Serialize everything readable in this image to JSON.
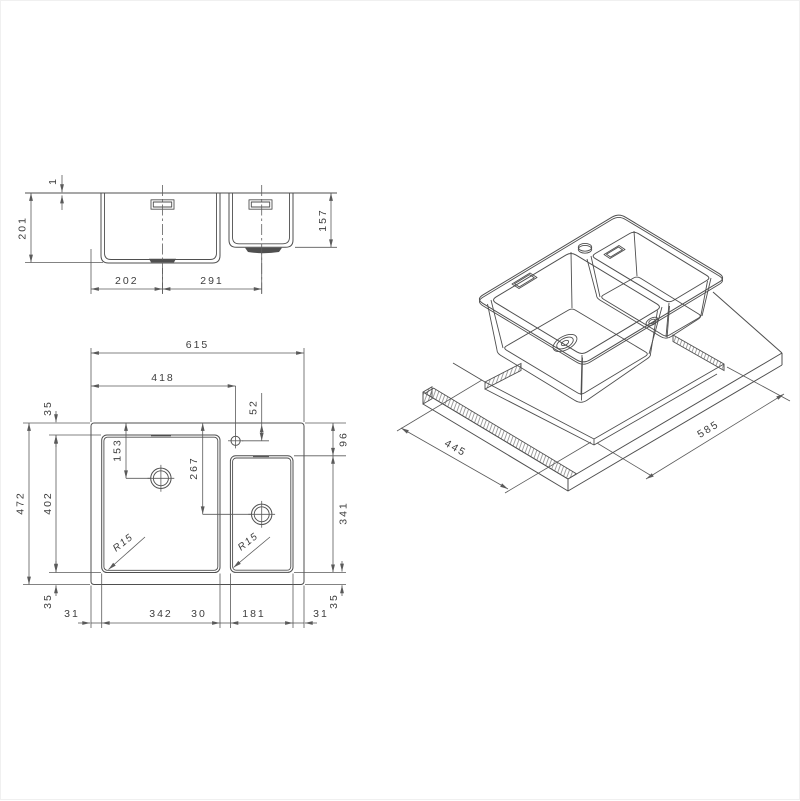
{
  "drawing": {
    "front_view": {
      "rim_thickness": "1",
      "bowl1_depth": "201",
      "bowl2_depth": "157",
      "bowl1_center_offset": "202",
      "bowl_center_distance": "291"
    },
    "plan_view": {
      "overall_width": "615",
      "tap_hole_from_left": "418",
      "tap_hole_from_top": "52",
      "bowl1_top_inset": "35",
      "bowl1_drain_from_top": "153",
      "bowl2_drain_from_top": "267",
      "bowl2_top_inset": "96",
      "overall_depth": "472",
      "bowl1_length": "402",
      "bowl2_length": "341",
      "bowl1_bottom_inset": "35",
      "bowl2_bottom_inset": "35",
      "left_inset": "31",
      "bowl1_width": "342",
      "bowl_gap": "30",
      "bowl2_width": "181",
      "right_inset": "31",
      "bowl1_corner_radius": "R15",
      "bowl2_corner_radius": "R15"
    },
    "iso_view": {
      "cutout_depth": "445",
      "cutout_width": "585"
    },
    "colors": {
      "line": "#4f4f4f",
      "text": "#3d3d3d",
      "background": "#ffffff"
    }
  }
}
